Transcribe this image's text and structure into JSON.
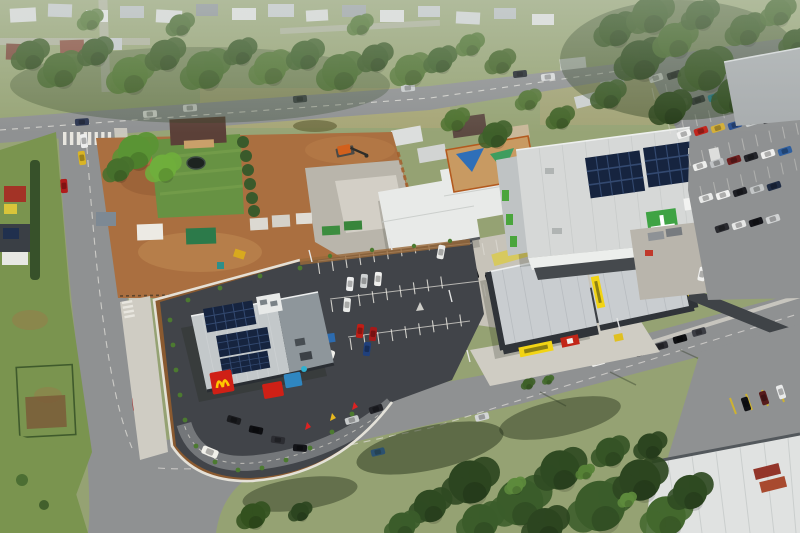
{
  "meta": {
    "description": "Aerial drone photograph of a newly built fast-food restaurant with drive-thru and car park, beside retail buildings, a supermarket and a construction site in a leafy suburb",
    "image_type": "aerial-photograph"
  },
  "palette": {
    "field": "#95a273",
    "grass": "#7a944f",
    "dirt": "#aa6f40",
    "gravel": "#b9b5ab",
    "road": "#8f9192",
    "new_asphalt": "#414449",
    "concrete": "#c7c3b9",
    "footpath": "#cfccc3",
    "roof_light": "#c3c8ca",
    "roof_white": "#e8eae8",
    "roof_retail": "#c9cdd0",
    "roof_supermarket": "#d6d8d7",
    "roof_warehouse": "#e0e2e1",
    "wall_dark": "#303439",
    "solar_panel": "#16243f",
    "brand_red": "#cf2016",
    "brand_yellow": "#ffc800",
    "brand_green": "#3fa344",
    "sign_yellow": "#f2d414",
    "sign_red": "#c22618",
    "tree_dark": "#2c4520",
    "tree_mid": "#3b5c2a",
    "tree_light": "#4e7433",
    "garden_soil": "#8a5a30",
    "lawn": "#679243",
    "playground_sand": "#c89a62"
  },
  "labels": {
    "scene": "aerial view of suburban retail precinct",
    "suburb": "residential suburb with houses and trees",
    "restaurant": "fast-food restaurant with rooftop solar panels",
    "restaurant_logo": "red sign with yellow arches logo",
    "drive_thru": "drive-thru lane with queued cars",
    "car_park": "new asphalt customer car park",
    "construction": "construction site with excavator and site sheds",
    "childcare": "white-roofed childcare centre with shade-sail playground",
    "retail": "retail buildings with yellow and red fascia signs",
    "supermarket": "supermarket with rooftop solar arrays and green entry",
    "supermarket_parking": "busy supermarket car park",
    "roads": "suburban roads with light traffic",
    "trees": "dense eucalyptus tree canopy",
    "warehouse": "industrial warehouse roof"
  }
}
